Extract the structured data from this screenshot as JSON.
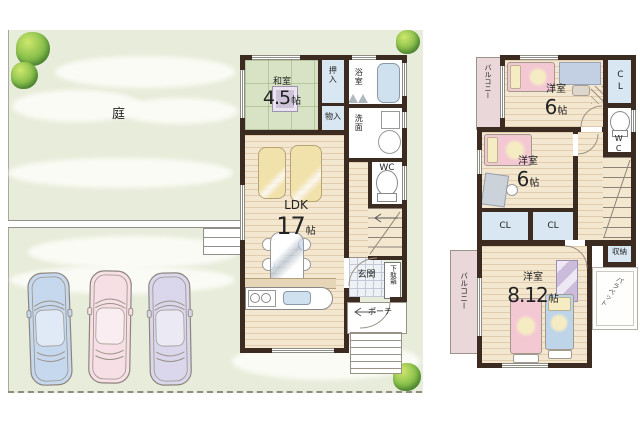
{
  "colors": {
    "wall": "#3b2b21",
    "wood": "#f4e7d0",
    "wood-line": "rgba(193,152,106,0.35)",
    "tatami": "#d8e3c6",
    "tatami-line": "rgba(140,165,110,0.45)",
    "closet": "#d8e7f2",
    "tile": "#eef1f5",
    "tile-line": "#c3cad6",
    "balcony": "#e9d7da",
    "site": "#e8ecda",
    "cloud": "#fcfdf8",
    "bed-pink": "#f3c8d3",
    "bed-blue": "#bdd4e9",
    "pillow": "#f6ecc3",
    "sofa": "#f1e1ab",
    "counter-wood": "#e6d5b7",
    "fixture-blue": "#cfe0ef",
    "car-blue": "#c6d8ee",
    "car-pink": "#f6dfe5",
    "car-purple": "#dad7ec",
    "tree-dark": "#5f9c3d",
    "tree-mid": "#8cc24d",
    "tree-light": "#cfe76d",
    "text": "#222222"
  },
  "site": {
    "garden_label": "庭"
  },
  "floor1": {
    "washitsu": {
      "name": "和室",
      "size": "4.5",
      "unit": "帖"
    },
    "oshiire": "押入",
    "monoire": "物入",
    "bath": "浴室",
    "senmen": "洗面",
    "wc": "WC",
    "ldk": {
      "name": "LDK",
      "size": "17",
      "unit": "帖"
    },
    "genkan": "玄関",
    "getabako": "下駄箱",
    "porch": "ポーチ"
  },
  "floor2": {
    "balcony_top": "バルコニー",
    "balcony_bottom": "バルコニー",
    "room1": {
      "name": "洋室",
      "size": "6",
      "unit": "帖"
    },
    "room2": {
      "name": "洋室",
      "size": "6",
      "unit": "帖"
    },
    "room3": {
      "name": "洋室",
      "size": "8.12",
      "unit": "帖"
    },
    "cl1": "CL",
    "cl2": "CL",
    "cl3": "CL",
    "wc": "WC",
    "shuno": "収納",
    "parapet": "パラペット"
  }
}
